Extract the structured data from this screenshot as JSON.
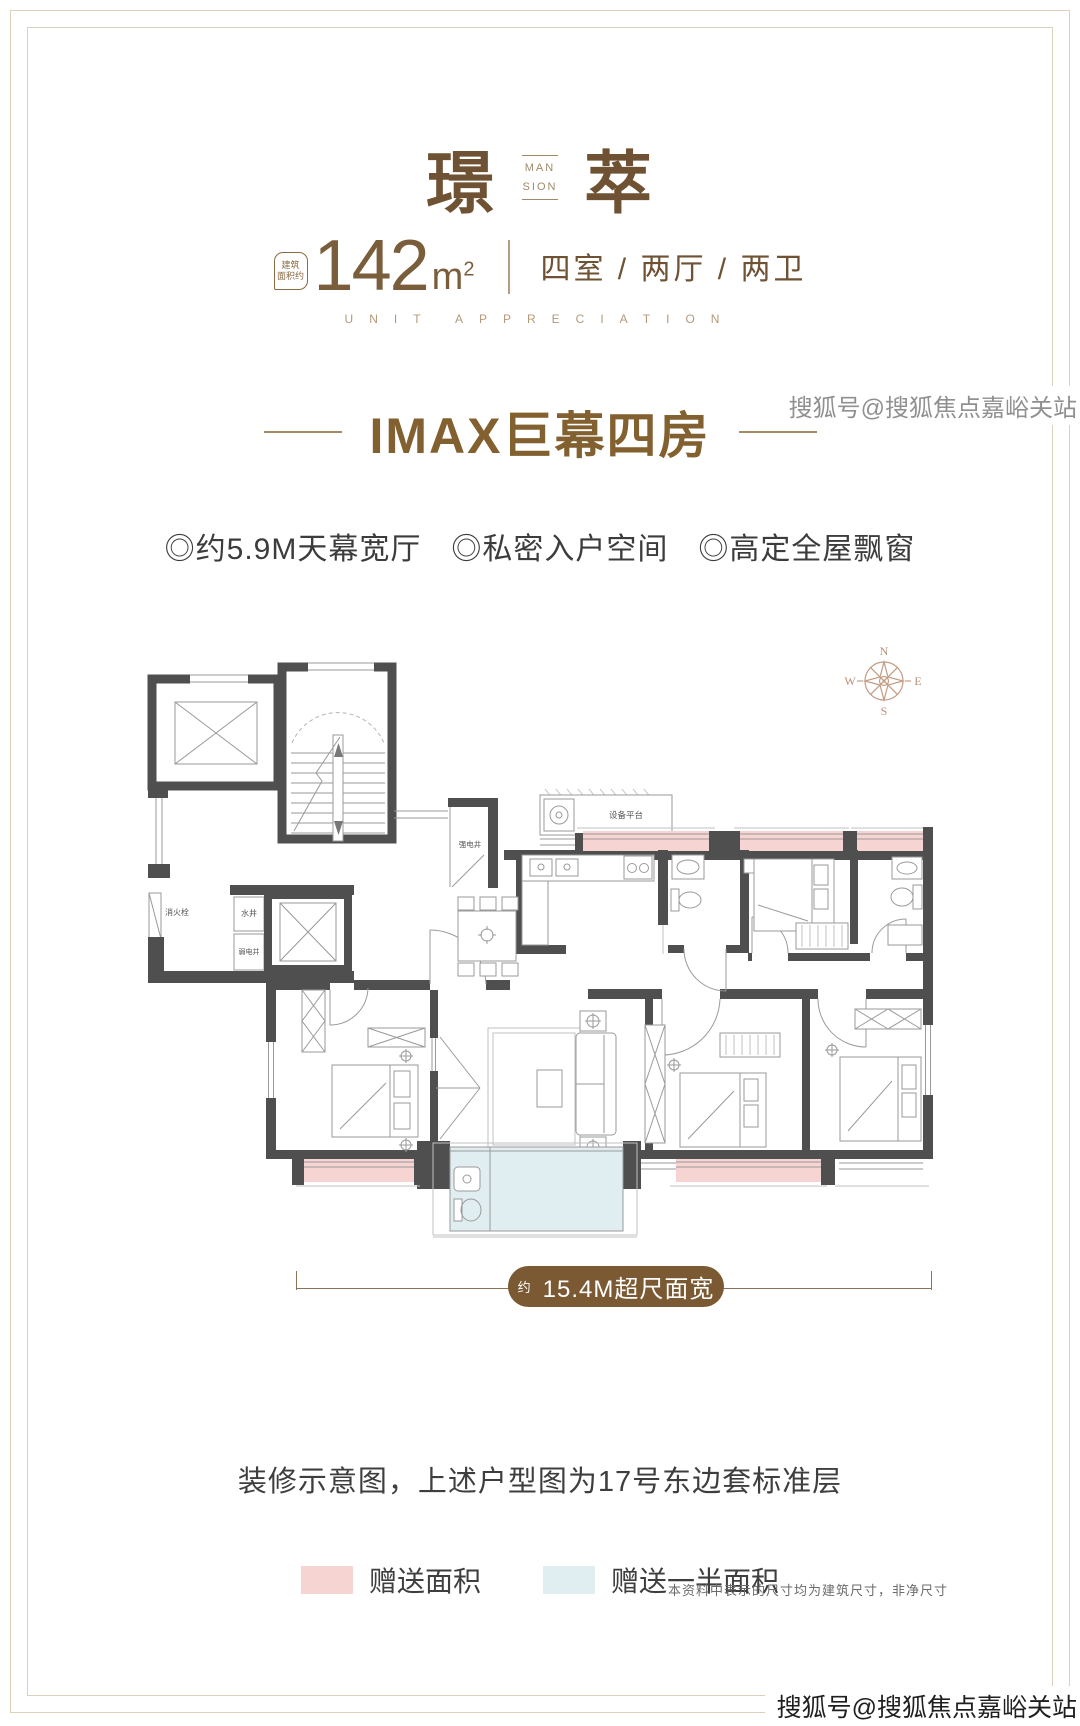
{
  "header": {
    "title_left": "璟",
    "title_right": "萃",
    "mansion_top": "MAN",
    "mansion_bottom": "SION",
    "badge_line1": "建筑",
    "badge_line2": "面积约",
    "area_number": "142",
    "area_unit": "m",
    "area_exponent": "2",
    "layout_text": "四室 / 两厅 / 两卫",
    "english_caption": "UNIT APPRECIATION"
  },
  "section": {
    "title": "IMAX巨幕四房",
    "features": [
      "◎约5.9M天幕宽厅",
      "◎私密入户空间",
      "◎高定全屋飘窗"
    ]
  },
  "floorplan": {
    "compass": {
      "n": "N",
      "e": "E",
      "s": "S",
      "w": "W"
    },
    "labels": {
      "fire_hydrant": "消火栓",
      "water_shaft": "水井",
      "weak_current_shaft": "弱电井",
      "strong_current_shaft": "强电井",
      "equipment_platform": "设备平台"
    },
    "dimension": {
      "prefix": "约",
      "text": "15.4M超尺面宽"
    },
    "colors": {
      "bonus_area": "#f5d4d1",
      "half_bonus_area": "#e0eef1",
      "wall": "#4f4f4f",
      "accent_brown": "#7b5a33"
    }
  },
  "footer": {
    "caption": "装修示意图，上述户型图为17号东边套标准层",
    "legend": [
      {
        "label": "赠送面积"
      },
      {
        "label": "赠送一半面积"
      }
    ],
    "note": "本资料中表示的尺寸均为建筑尺寸，非净尺寸",
    "watermark": "搜狐号@搜狐焦点嘉峪关站"
  }
}
